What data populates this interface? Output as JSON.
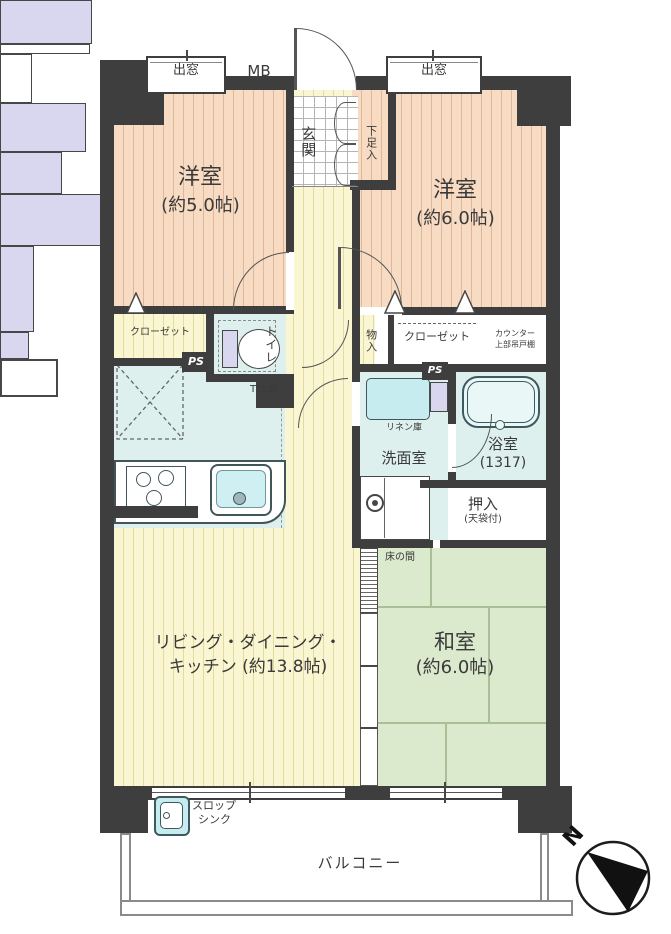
{
  "fp": {
    "western5": {
      "name": "洋室",
      "size": "(約5.0帖)"
    },
    "western6": {
      "name": "洋室",
      "size": "(約6.0帖)"
    },
    "ldk": {
      "line1": "リビング・ダイニング・",
      "line2": "キッチン (約13.8帖)"
    },
    "washitsu": {
      "name": "和室",
      "size": "(約6.0帖)"
    },
    "entrance": "玄関",
    "shoe_box": "下足入",
    "washroom": "洗面室",
    "bathroom": "浴室",
    "bathroom_size": "(1317)",
    "toilet": "トイレ",
    "oshiire": "押入",
    "oshiire_note": "(天袋付)",
    "tokonoma": "床の間",
    "closet_left": "クローゼット",
    "closet_right": "クローゼット",
    "counter_l1": "カウンター",
    "counter_l2": "上部吊戸棚",
    "storage": "物入",
    "linen": "リネン庫",
    "tel": "TEL台",
    "balcony": "バルコニー",
    "slop_l1": "スロップ",
    "slop_l2": "シンク",
    "bay_left": "出窓",
    "bay_right": "出窓",
    "mb": "MB",
    "ps_left": "PS",
    "ps_right": "PS",
    "north": "N",
    "colors": {
      "wall": "#3e3e3e",
      "western_room": "#f7dcc3",
      "ldk_floor": "#faf6d2",
      "tatami": "#dbe9cd",
      "water_area": "#def0ee",
      "closet": "#d9d6ef"
    }
  }
}
